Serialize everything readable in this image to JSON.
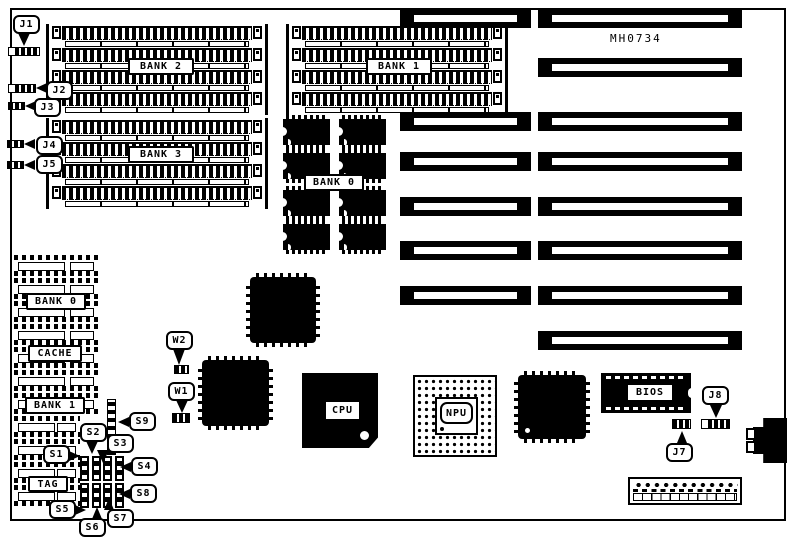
{
  "board": {
    "silkscreen": "MH0734"
  },
  "labels": {
    "bank2": "BANK 2",
    "bank3": "BANK 3",
    "bank1_simm": "BANK 1",
    "bank0_dip": "BANK 0",
    "bank0_sram": "BANK 0",
    "cache": "CACHE",
    "bank1_sram": "BANK 1",
    "tag": "TAG",
    "cpu": "CPU",
    "npu": "NPU",
    "bios": "BIOS"
  },
  "callouts": {
    "j1": "J1",
    "j2": "J2",
    "j3": "J3",
    "j4": "J4",
    "j5": "J5",
    "j7": "J7",
    "j8": "J8",
    "w1": "W1",
    "w2": "W2",
    "s1": "S1",
    "s2": "S2",
    "s3": "S3",
    "s4": "S4",
    "s5": "S5",
    "s6": "S6",
    "s7": "S7",
    "s8": "S8",
    "s9": "S9"
  },
  "colors": {
    "ink": "#000000",
    "paper": "#ffffff"
  }
}
